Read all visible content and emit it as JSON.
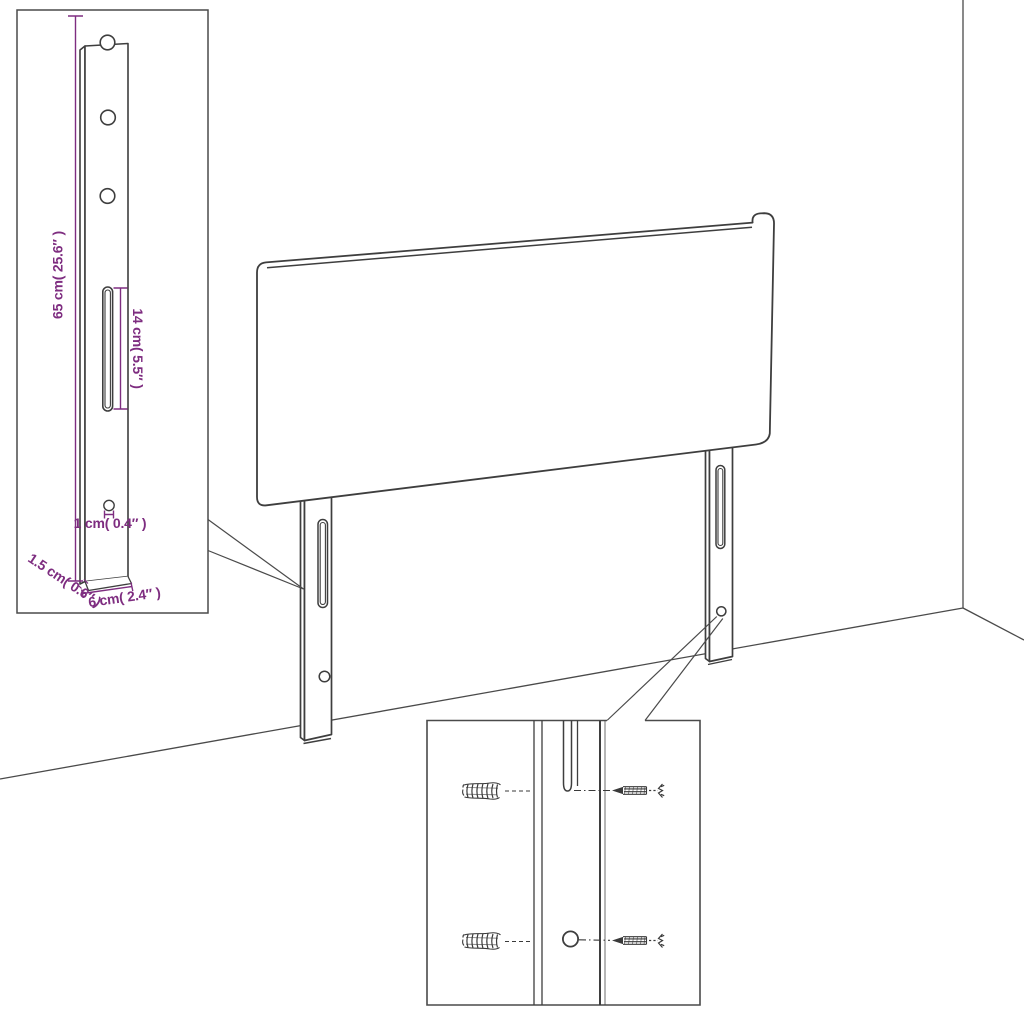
{
  "page": {
    "background": "#ffffff"
  },
  "colors": {
    "line": "#3e3e3e",
    "room_line": "#4a4a4a",
    "inset_border": "#4a4a4a",
    "dimension": "#7e2d80"
  },
  "main_view": {
    "parts": [
      "headboard-panel",
      "left-mounting-leg",
      "right-mounting-leg",
      "wall-corner",
      "floor-line"
    ]
  },
  "leg_detail_inset": {
    "features": [
      "screw-hole-top",
      "screw-hole-middle",
      "screw-hole-bottom",
      "adjustment-slot",
      "small-hole"
    ],
    "dimensions": {
      "height": "65 cm( 25.6″ )",
      "slot_length": "14 cm( 5.5″ )",
      "hole": "1 cm( 0.4″ )",
      "thickness": "1.5 cm( 0.6″ )",
      "width": "6 cm( 2.4″ )"
    }
  },
  "mounting_detail_inset": {
    "parts": [
      "wall-plug-upper",
      "wall-plug-lower",
      "screw-upper",
      "screw-lower",
      "leg-slot",
      "leg-hole"
    ]
  }
}
